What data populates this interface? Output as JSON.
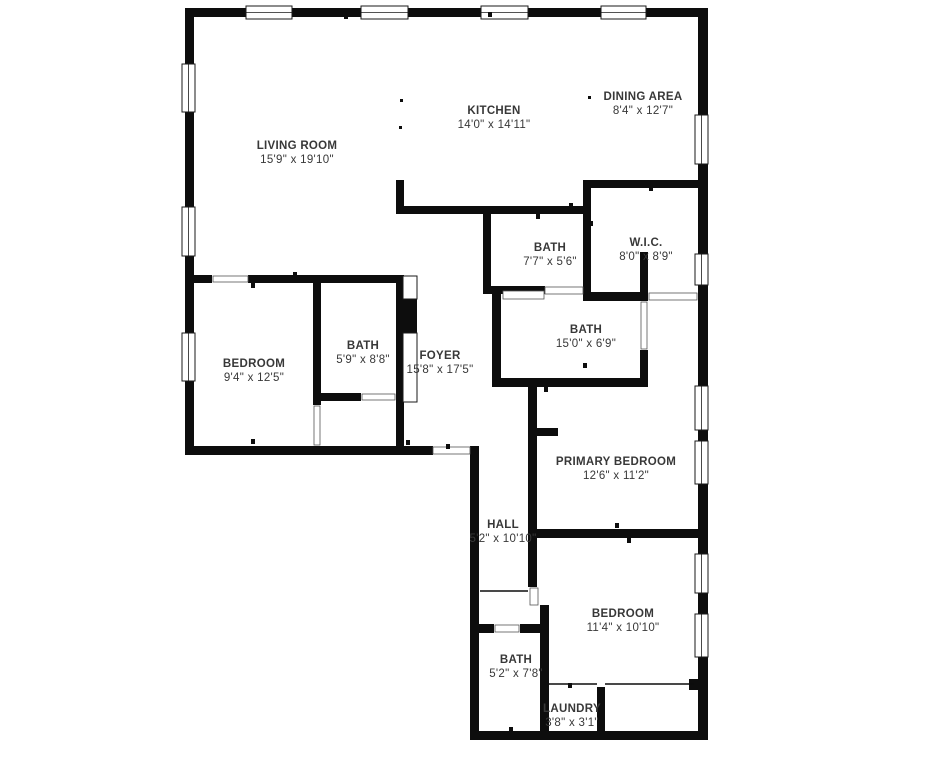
{
  "canvas": {
    "width": 945,
    "height": 768,
    "background_color": "#ffffff",
    "wall_color": "#0d0d0d",
    "label_color": "#383838",
    "window_border_color": "#1a1a1a",
    "door_jamb_color": "#555555"
  },
  "floor_plan": {
    "rooms": [
      {
        "id": "living-room",
        "name": "LIVING ROOM",
        "dimensions": "15'9\" x 19'10\"",
        "label_x": 297,
        "label_y": 149
      },
      {
        "id": "kitchen",
        "name": "KITCHEN",
        "dimensions": "14'0\" x 14'11\"",
        "label_x": 494,
        "label_y": 114
      },
      {
        "id": "dining-area",
        "name": "DINING AREA",
        "dimensions": "8'4\" x 12'7\"",
        "label_x": 643,
        "label_y": 100
      },
      {
        "id": "wic",
        "name": "W.I.C.",
        "dimensions": "8'0\" x 8'9\"",
        "label_x": 646,
        "label_y": 246
      },
      {
        "id": "bath-upper",
        "name": "BATH",
        "dimensions": "7'7\" x 5'6\"",
        "label_x": 550,
        "label_y": 251
      },
      {
        "id": "bath-middle",
        "name": "BATH",
        "dimensions": "15'0\" x 6'9\"",
        "label_x": 586,
        "label_y": 333
      },
      {
        "id": "bedroom-left",
        "name": "BEDROOM",
        "dimensions": "9'4\" x 12'5\"",
        "label_x": 254,
        "label_y": 367
      },
      {
        "id": "bath-left",
        "name": "BATH",
        "dimensions": "5'9\" x 8'8\"",
        "label_x": 363,
        "label_y": 349
      },
      {
        "id": "foyer",
        "name": "FOYER",
        "dimensions": "15'8\" x 17'5\"",
        "label_x": 440,
        "label_y": 359
      },
      {
        "id": "primary-bedroom",
        "name": "PRIMARY BEDROOM",
        "dimensions": "12'6\" x 11'2\"",
        "label_x": 616,
        "label_y": 465
      },
      {
        "id": "hall",
        "name": "HALL",
        "dimensions": "5'2\" x 10'10\"",
        "label_x": 503,
        "label_y": 528
      },
      {
        "id": "bedroom-bottom",
        "name": "BEDROOM",
        "dimensions": "11'4\" x 10'10\"",
        "label_x": 623,
        "label_y": 617
      },
      {
        "id": "bath-bottom",
        "name": "BATH",
        "dimensions": "5'2\" x 7'8\"",
        "label_x": 516,
        "label_y": 663
      },
      {
        "id": "laundry",
        "name": "LAUNDRY",
        "dimensions": "3'8\" x 3'1\"",
        "label_x": 572,
        "label_y": 712
      }
    ],
    "walls": [
      [
        185,
        8,
        523,
        9
      ],
      [
        185,
        8,
        9,
        447
      ],
      [
        698,
        8,
        10,
        732
      ],
      [
        185,
        446,
        248,
        9
      ],
      [
        470,
        446,
        9,
        294
      ],
      [
        470,
        731,
        238,
        9
      ],
      [
        396,
        180,
        8,
        34
      ],
      [
        396,
        206,
        195,
        8
      ],
      [
        583,
        180,
        8,
        120
      ],
      [
        583,
        180,
        125,
        8
      ],
      [
        583,
        292,
        65,
        9
      ],
      [
        640,
        252,
        8,
        49
      ],
      [
        483,
        206,
        8,
        88
      ],
      [
        483,
        286,
        62,
        8
      ],
      [
        492,
        288,
        9,
        99
      ],
      [
        492,
        378,
        156,
        9
      ],
      [
        640,
        350,
        8,
        37
      ],
      [
        185,
        275,
        27,
        8
      ],
      [
        248,
        275,
        156,
        8
      ],
      [
        313,
        283,
        8,
        122
      ],
      [
        396,
        275,
        8,
        172
      ],
      [
        313,
        393,
        48,
        8
      ],
      [
        528,
        387,
        9,
        151
      ],
      [
        537,
        428,
        21,
        8
      ],
      [
        528,
        529,
        180,
        9
      ],
      [
        528,
        538,
        9,
        49
      ],
      [
        540,
        605,
        9,
        126
      ],
      [
        470,
        624,
        24,
        9
      ],
      [
        520,
        624,
        29,
        9
      ],
      [
        597,
        687,
        8,
        44
      ],
      [
        689,
        679,
        9,
        11
      ]
    ],
    "windows": [
      [
        246,
        6,
        46,
        13
      ],
      [
        361,
        6,
        47,
        13
      ],
      [
        481,
        6,
        47,
        13
      ],
      [
        601,
        6,
        45,
        13
      ],
      [
        182,
        64,
        13,
        48
      ],
      [
        182,
        207,
        13,
        49
      ],
      [
        182,
        333,
        13,
        48
      ],
      [
        695,
        115,
        13,
        49
      ],
      [
        695,
        254,
        13,
        31
      ],
      [
        695,
        386,
        13,
        44
      ],
      [
        695,
        441,
        13,
        43
      ],
      [
        695,
        554,
        13,
        39
      ],
      [
        695,
        614,
        13,
        43
      ]
    ],
    "door_openings": [
      [
        213,
        276,
        35,
        6
      ],
      [
        362,
        394,
        33,
        6
      ],
      [
        545,
        287,
        38,
        7
      ],
      [
        433,
        447,
        37,
        7
      ],
      [
        530,
        588,
        8,
        17
      ],
      [
        641,
        302,
        6,
        47
      ],
      [
        649,
        293,
        48,
        7
      ],
      [
        495,
        625,
        24,
        7
      ],
      [
        314,
        406,
        6,
        39
      ],
      [
        503,
        291,
        41,
        8
      ]
    ],
    "thin_partitions": [
      [
        549,
        684,
        597,
        684
      ],
      [
        605,
        684,
        694,
        684
      ],
      [
        480,
        591,
        528,
        591
      ]
    ],
    "entry_door_leaf": [
      397,
      299,
      20,
      34
    ],
    "closet_panels": [
      [
        403,
        276,
        14,
        23
      ],
      [
        403,
        333,
        14,
        69
      ]
    ],
    "wall_ticks": [
      [
        344,
        14
      ],
      [
        488,
        12
      ],
      [
        251,
        439
      ],
      [
        406,
        440
      ],
      [
        446,
        444
      ],
      [
        189,
        124
      ],
      [
        536,
        214
      ],
      [
        589,
        221
      ],
      [
        485,
        249
      ],
      [
        569,
        203
      ],
      [
        649,
        186
      ],
      [
        615,
        523
      ],
      [
        627,
        538
      ],
      [
        531,
        460
      ],
      [
        474,
        647
      ],
      [
        509,
        727
      ],
      [
        568,
        683
      ],
      [
        544,
        387
      ],
      [
        583,
        363
      ],
      [
        293,
        272
      ],
      [
        251,
        283
      ]
    ],
    "column_dots": [
      [
        400,
        99
      ],
      [
        399,
        126
      ],
      [
        588,
        96
      ]
    ]
  }
}
